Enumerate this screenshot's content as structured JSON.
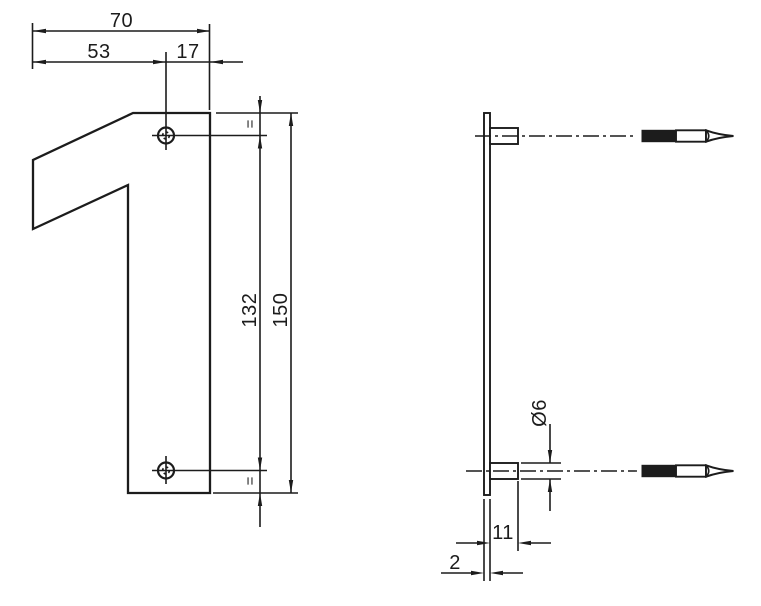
{
  "title": "House number 1 — dimensioned technical drawing",
  "front_view": {
    "width_total": "70",
    "width_to_hole": "53",
    "width_hole_to_edge": "17",
    "hole_spacing": "132",
    "height_total": "150",
    "equal_margin_top": "=",
    "equal_margin_bottom": "="
  },
  "side_view": {
    "pin_diameter": "Ø6",
    "boss_length": "11",
    "plate_thickness": "2"
  },
  "colors": {
    "line": "#1c1c1c",
    "background": "#ffffff"
  }
}
